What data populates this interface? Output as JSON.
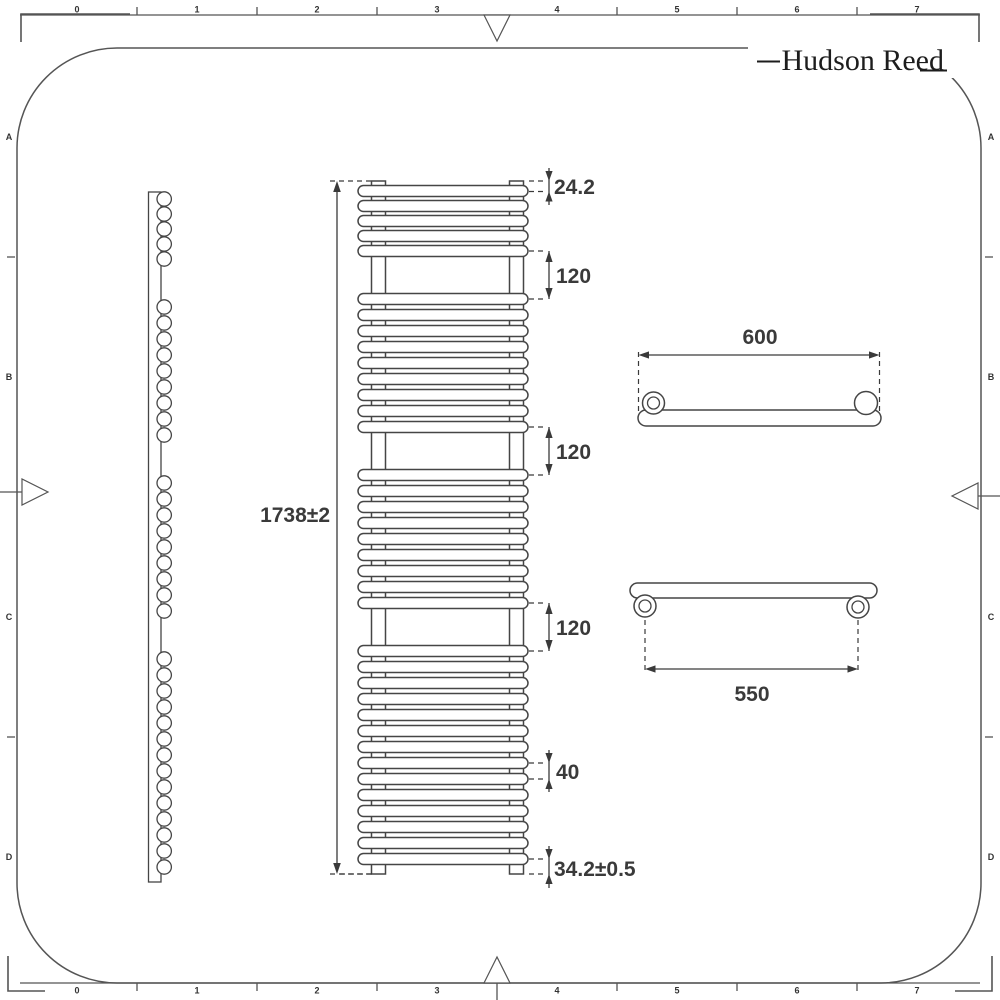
{
  "brand": {
    "name": "Hudson Reed"
  },
  "rulers": {
    "top": [
      "0",
      "1",
      "2",
      "3",
      "4",
      "5",
      "6",
      "7"
    ],
    "bottom": [
      "0",
      "1",
      "2",
      "3",
      "4",
      "5",
      "6",
      "7"
    ],
    "left": [
      "A",
      "B",
      "C",
      "D"
    ],
    "right": [
      "A",
      "B",
      "C",
      "D"
    ]
  },
  "views": {
    "front": {
      "bar_groups": [
        5,
        9,
        9,
        14
      ]
    },
    "side": {
      "rung_groups": [
        5,
        9,
        9,
        14
      ]
    }
  },
  "dimensions": {
    "overall_height": "1738±2",
    "top_offset": "24.2",
    "gap_1": "120",
    "gap_2": "120",
    "gap_3": "120",
    "bar_pitch": "40",
    "bottom_offset": "34.2±0.5",
    "overall_width": "600",
    "fixing_centres": "550"
  },
  "colors": {
    "line": "#454545",
    "dim": "#3a3a3a",
    "frame": "#555555",
    "background": "#ffffff"
  }
}
